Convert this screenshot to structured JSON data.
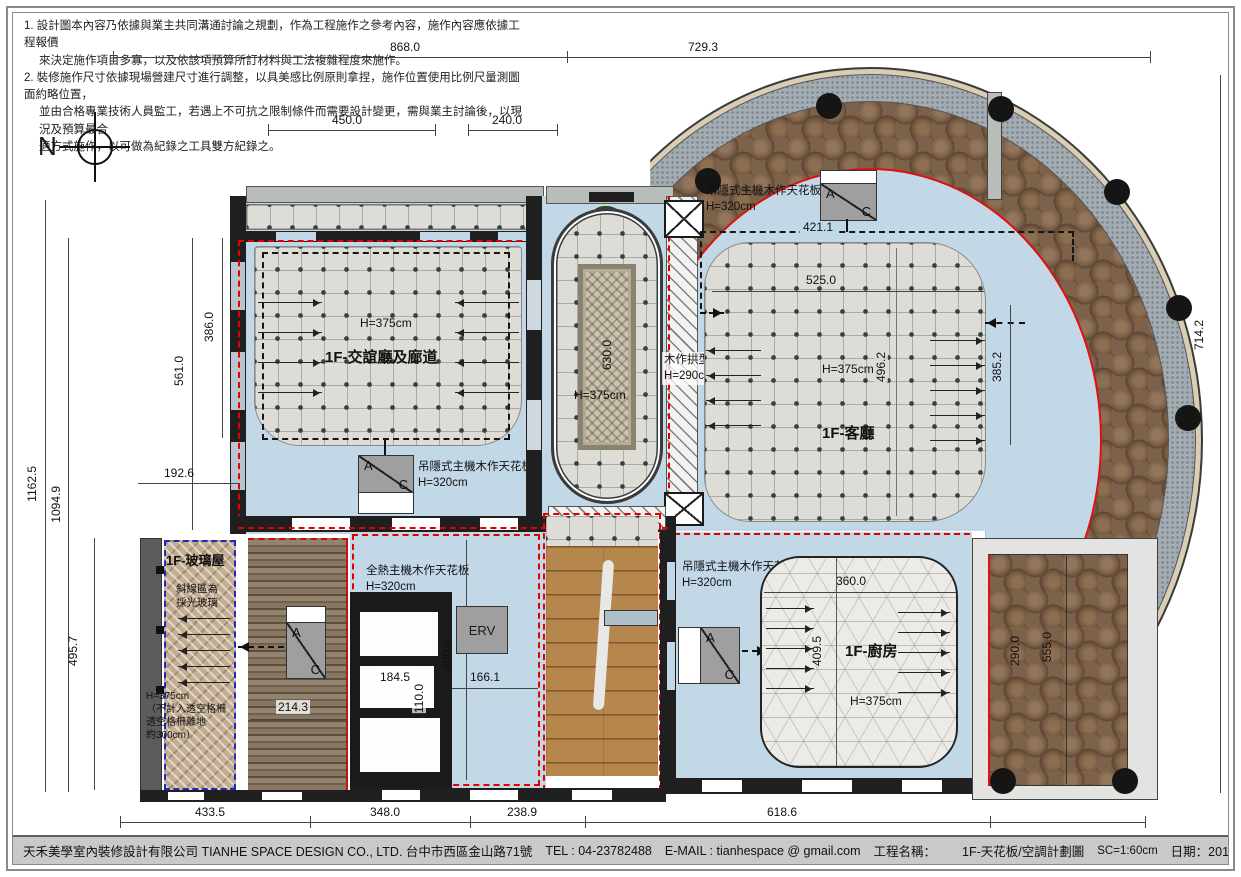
{
  "notes": {
    "n1_l1": "1. 設計圖本內容乃依據與業主共同溝通討論之規劃，作為工程施作之參考內容，施作內容應依據工程報價",
    "n1_l2": "來決定施作項目多寡，以及依該項預算所訂材料與工法複雜程度來施作。",
    "n2_l1": "2. 裝修施作尺寸依據現場營建尺寸進行調整，以具美感比例原則拿捏，施作位置使用比例尺量測圖面約略位置，",
    "n2_l2": "並由合格專業技術人員監工，若遇上不可抗之限制條件而需要設計變更，需與業主討論後，以現況及預算最合",
    "n2_l3": "適方式施作，以可做為紀錄之工具雙方紀錄之。"
  },
  "north": "N",
  "rooms": {
    "lounge": {
      "name": "1F-交誼廳及廊道",
      "height": "H=375cm"
    },
    "living": {
      "name": "1F-客廳",
      "height": "H=375cm"
    },
    "foyer": {
      "height": "H=375cm"
    },
    "kitchen": {
      "name": "1F-廚房",
      "height": "H=375cm"
    },
    "glass": {
      "name": "1F-玻璃屋",
      "hatch_note1": "斜線區為",
      "hatch_note2": "採光玻璃",
      "height": "H=375cm",
      "note1": "（不計入透空格柵",
      "note2": "透空格柵離地",
      "note3": "約300cm）"
    }
  },
  "labels": {
    "ceiling_ac": "吊隱式主機木作天花板",
    "ceiling_ac_h": "H=320cm",
    "ceiling_erv": "全熱主機木作天花板",
    "ceiling_erv_h": "H=320cm",
    "beam": "木作拱型樑",
    "beam_h": "H=290cm"
  },
  "equipment": {
    "ac_a": "A",
    "ac_c": "C",
    "erv": "ERV"
  },
  "dims": {
    "t868": "868.0",
    "t7293": "729.3",
    "t450": "450.0",
    "t240": "240.0",
    "l11625": "1162.5",
    "l10949": "1094.9",
    "l386": "386.0",
    "l561": "561.0",
    "l1926": "192.6",
    "l4957": "495.7",
    "r7142": "714.2",
    "i4211": "421.1",
    "i525": "525.0",
    "i4962": "496.2",
    "i3852": "385.2",
    "i630": "630.0",
    "i2143": "214.3",
    "i1845": "184.5",
    "i110": "110.0",
    "i5008": "500.8",
    "i1661": "166.1",
    "i360": "360.0",
    "i4095": "409.5",
    "i290": "290.0",
    "i555": "555.0",
    "b4335": "433.5",
    "b348": "348.0",
    "b2389": "238.9",
    "b6186": "618.6"
  },
  "titlebar": {
    "company": "天禾美學室內裝修設計有限公司 TIANHE SPACE DESIGN CO., LTD. 台中市西區金山路71號",
    "tel": "TEL : 04-23782488",
    "email": "E-MAIL : tianhespace @ gmail.com",
    "project_label": "工程名稱：",
    "drawing_title": "1F-天花板/空調計劃圖",
    "scale": "SC=1:60cm",
    "date": "日期：2018.5.31",
    "sheet": "1F-004"
  }
}
